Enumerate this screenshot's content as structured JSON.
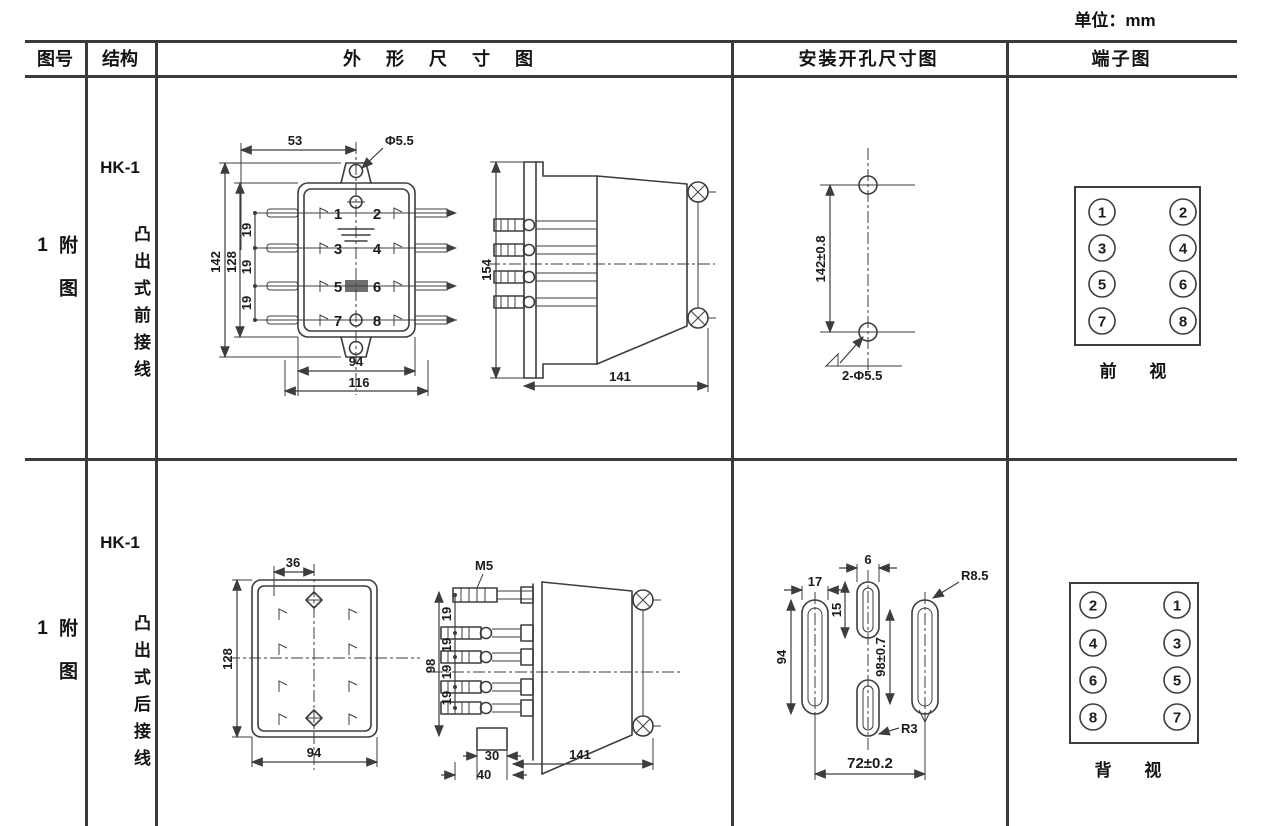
{
  "unit_label": "单位：mm",
  "header": {
    "figure_no": "图号",
    "structure": "结构",
    "outline": "外 形 尺 寸 图",
    "mounting": "安装开孔尺寸图",
    "terminal": "端子图"
  },
  "row1": {
    "figure_no": "附图1",
    "model": "HK-1",
    "structure": "凸出式前接线",
    "front": {
      "dim_53": "53",
      "dim_hole": "Φ5.5",
      "dim_142": "142",
      "dim_128": "128",
      "pitch": [
        "19",
        "19",
        "19"
      ],
      "t": [
        "1",
        "2",
        "3",
        "4",
        "5",
        "6",
        "7",
        "8"
      ],
      "dim_94": "94",
      "dim_116": "116"
    },
    "side": {
      "dim_154": "154",
      "dim_141": "141"
    },
    "mounting": {
      "dim_142": "142±0.8",
      "holes": "2-Φ5.5"
    },
    "terminal": {
      "n": [
        "1",
        "2",
        "3",
        "4",
        "5",
        "6",
        "7",
        "8"
      ],
      "view": "前 视"
    }
  },
  "row2": {
    "figure_no": "附图1",
    "model": "HK-1",
    "structure": "凸出式后接线",
    "rear": {
      "dim_36": "36",
      "dim_128": "128",
      "dim_94": "94"
    },
    "side": {
      "stud": "M5",
      "dim_98": "98",
      "pitch": [
        "19",
        "19",
        "19",
        "19"
      ],
      "dim_30": "30",
      "dim_40": "40",
      "dim_141": "141"
    },
    "mounting": {
      "dim_17": "17",
      "dim_6": "6",
      "dim_15": "15",
      "dim_94": "94",
      "dim_98": "98±0.7",
      "r85": "R8.5",
      "r3": "R3",
      "dim_72": "72±0.2"
    },
    "terminal": {
      "n": [
        "2",
        "1",
        "4",
        "3",
        "6",
        "5",
        "8",
        "7"
      ],
      "view": "背 视"
    }
  }
}
